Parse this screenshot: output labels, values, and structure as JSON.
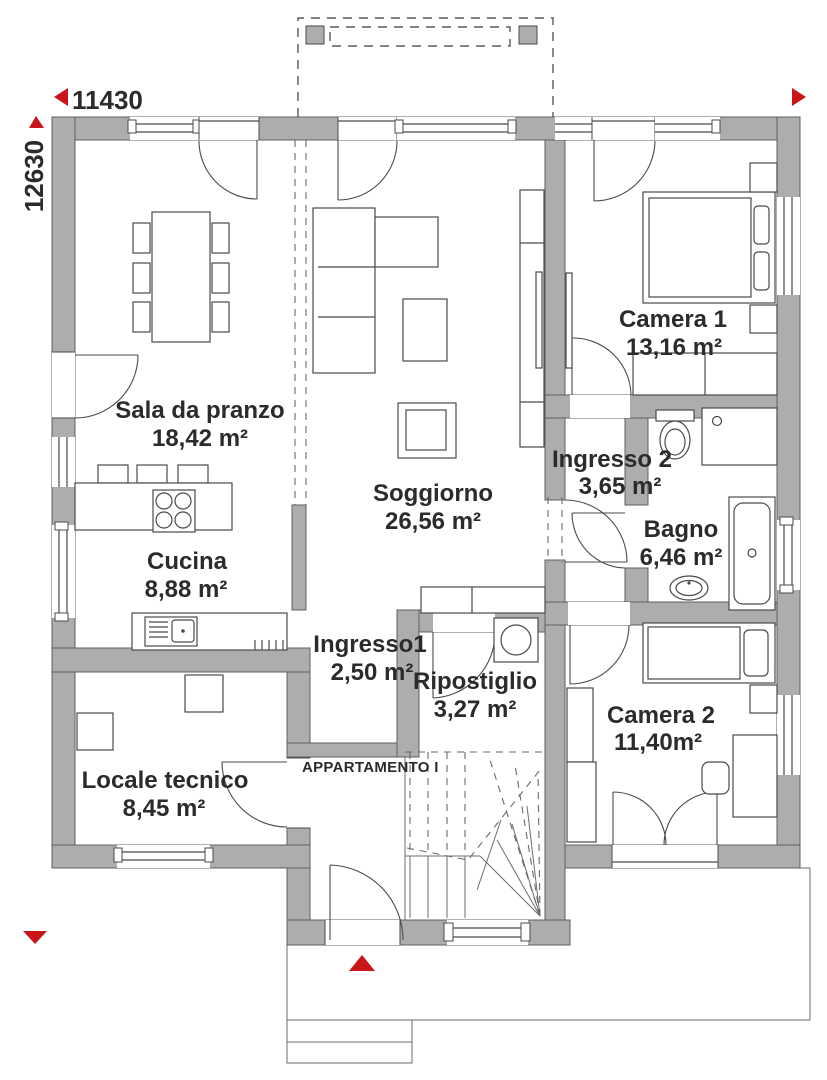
{
  "plan": {
    "dims": {
      "width_label": "11430",
      "height_label": "12630"
    },
    "apartment_label": "APPARTAMENTO I",
    "rooms": [
      {
        "id": "sala-da-pranzo",
        "name": "Sala da pranzo",
        "area": "18,42 m²"
      },
      {
        "id": "soggiorno",
        "name": "Soggiorno",
        "area": "26,56 m²"
      },
      {
        "id": "cucina",
        "name": "Cucina",
        "area": "8,88 m²"
      },
      {
        "id": "camera-1",
        "name": "Camera 1",
        "area": "13,16 m²"
      },
      {
        "id": "ingresso-2",
        "name": "Ingresso 2",
        "area": "3,65 m²"
      },
      {
        "id": "bagno",
        "name": "Bagno",
        "area": "6,46 m²"
      },
      {
        "id": "ingresso-1",
        "name": "Ingresso1",
        "area": "2,50 m²"
      },
      {
        "id": "ripostiglio",
        "name": "Ripostiglio",
        "area": "3,27 m²"
      },
      {
        "id": "camera-2",
        "name": "Camera 2",
        "area": "11,40m²"
      },
      {
        "id": "locale-tecnico",
        "name": "Locale tecnico",
        "area": "8,45 m²"
      }
    ],
    "colors": {
      "wall": "#adadad",
      "line": "#4a4a4a",
      "accent_red": "#c9141a",
      "text": "#2b2b2b"
    }
  }
}
